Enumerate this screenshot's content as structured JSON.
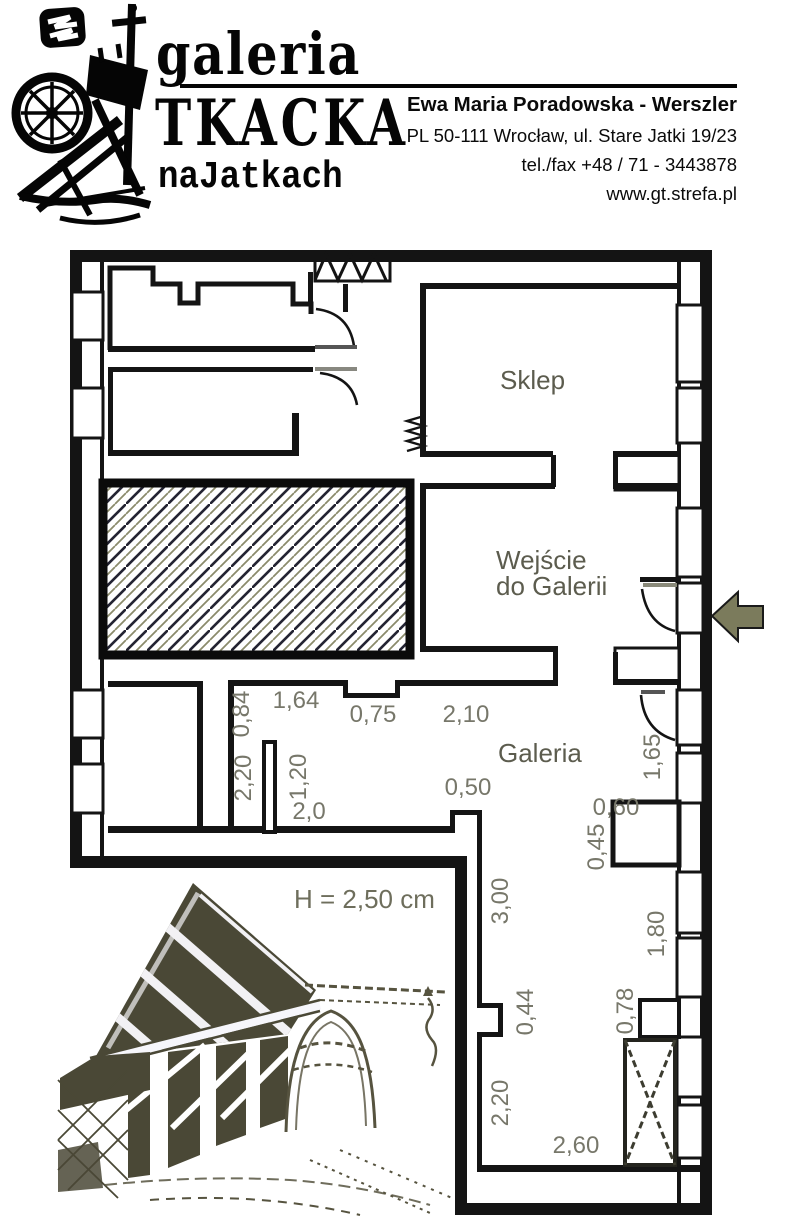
{
  "header": {
    "brand": {
      "line1": "galeria",
      "line2": "TKACKA",
      "line3": "naJatkach"
    },
    "contact": {
      "name": "Ewa Maria Poradowska - Werszler",
      "address": "PL 50-111 Wrocław, ul. Stare Jatki 19/23",
      "phone": "tel./fax +48 / 71 - 3443878",
      "website": "www.gt.strefa.pl"
    }
  },
  "plan": {
    "rooms": {
      "shop": "Sklep",
      "entrance_line1": "Wejście",
      "entrance_line2": "do Galerii",
      "gallery": "Galeria"
    },
    "height_note": "H = 2,50 cm",
    "dims": {
      "w084": "0,84",
      "w164": "1,64",
      "w075": "0,75",
      "w210": "2,10",
      "h220a": "2,20",
      "h120": "1,20",
      "w20": "2,0",
      "w050": "0,50",
      "h165": "1,65",
      "w060": "0,60",
      "h045": "0,45",
      "h300": "3,00",
      "h180": "1,80",
      "h044": "0,44",
      "h078": "0,78",
      "h220b": "2,20",
      "w260": "2,60"
    },
    "colors": {
      "wall": "#141414",
      "dim_text": "#77776a",
      "room_text": "#5c5c4e",
      "arrow_fill": "#7b7b5c"
    }
  }
}
